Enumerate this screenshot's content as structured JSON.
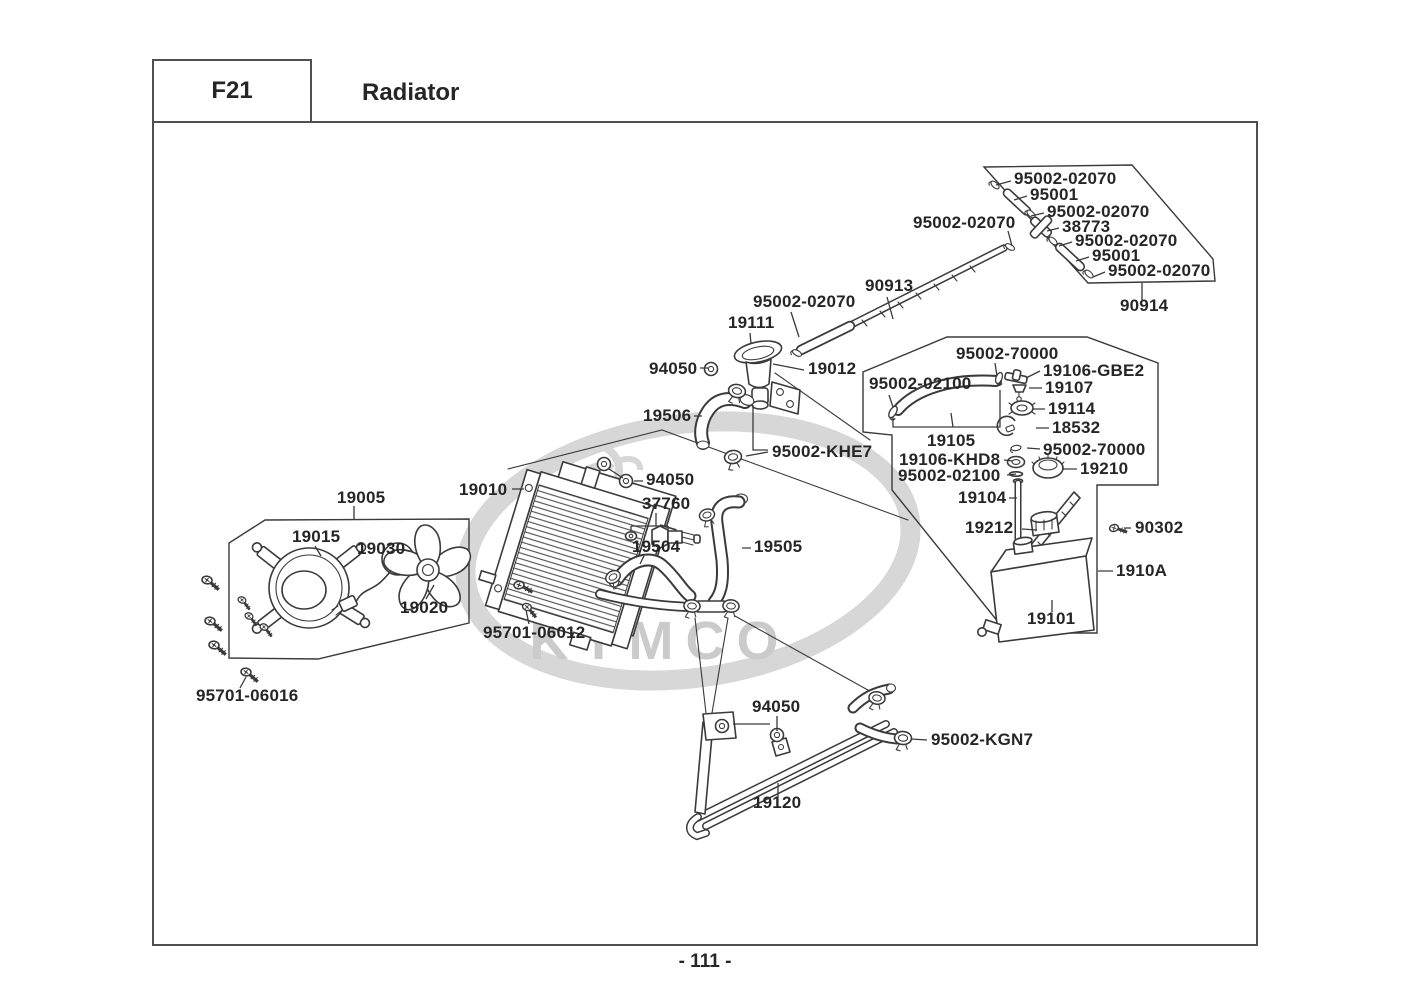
{
  "page": {
    "section_code": "F21",
    "title": "Radiator",
    "page_number": "- 111 -",
    "watermark": "KYMCO"
  },
  "colors": {
    "line": "#3a3a3a",
    "label": "#262626",
    "border": "#4f4f4f",
    "watermark_ring": "#d7d7d7",
    "watermark_text": "#cbcbcb",
    "background": "#ffffff"
  },
  "diagram": {
    "description": "Exploded parts diagram of radiator assembly with part numbers",
    "labels": [
      {
        "text": "95002-02070",
        "x": 1014,
        "y": 179
      },
      {
        "text": "95001",
        "x": 1030,
        "y": 195
      },
      {
        "text": "95002-02070",
        "x": 1047,
        "y": 212
      },
      {
        "text": "38773",
        "x": 1062,
        "y": 227
      },
      {
        "text": "95002-02070",
        "x": 1075,
        "y": 241
      },
      {
        "text": "95001",
        "x": 1092,
        "y": 256
      },
      {
        "text": "95002-02070",
        "x": 1108,
        "y": 271
      },
      {
        "text": "90914",
        "x": 1120,
        "y": 306
      },
      {
        "text": "95002-02070",
        "x": 913,
        "y": 223
      },
      {
        "text": "90913",
        "x": 865,
        "y": 286
      },
      {
        "text": "95002-02070",
        "x": 753,
        "y": 302
      },
      {
        "text": "19111",
        "x": 728,
        "y": 323
      },
      {
        "text": "94050",
        "x": 649,
        "y": 369
      },
      {
        "text": "19012",
        "x": 808,
        "y": 369
      },
      {
        "text": "95002-70000",
        "x": 956,
        "y": 354
      },
      {
        "text": "95002-02100",
        "x": 869,
        "y": 384
      },
      {
        "text": "19106-GBE2",
        "x": 1043,
        "y": 371
      },
      {
        "text": "19107",
        "x": 1045,
        "y": 388
      },
      {
        "text": "19114",
        "x": 1048,
        "y": 409
      },
      {
        "text": "18532",
        "x": 1052,
        "y": 428
      },
      {
        "text": "19105",
        "x": 927,
        "y": 441
      },
      {
        "text": "95002-70000",
        "x": 1043,
        "y": 450
      },
      {
        "text": "19106-KHD8",
        "x": 899,
        "y": 460
      },
      {
        "text": "19210",
        "x": 1080,
        "y": 469
      },
      {
        "text": "95002-02100",
        "x": 898,
        "y": 476
      },
      {
        "text": "19104",
        "x": 958,
        "y": 498
      },
      {
        "text": "19506",
        "x": 643,
        "y": 416
      },
      {
        "text": "95002-KHE7",
        "x": 772,
        "y": 452
      },
      {
        "text": "19005",
        "x": 337,
        "y": 498
      },
      {
        "text": "19010",
        "x": 459,
        "y": 490
      },
      {
        "text": "94050",
        "x": 646,
        "y": 480
      },
      {
        "text": "37760",
        "x": 642,
        "y": 504
      },
      {
        "text": "19015",
        "x": 292,
        "y": 537
      },
      {
        "text": "19030",
        "x": 357,
        "y": 549
      },
      {
        "text": "19504",
        "x": 632,
        "y": 547
      },
      {
        "text": "19505",
        "x": 754,
        "y": 547
      },
      {
        "text": "19212",
        "x": 965,
        "y": 528
      },
      {
        "text": "90302",
        "x": 1135,
        "y": 528
      },
      {
        "text": "1910A",
        "x": 1116,
        "y": 571
      },
      {
        "text": "19020",
        "x": 400,
        "y": 608
      },
      {
        "text": "19101",
        "x": 1027,
        "y": 619
      },
      {
        "text": "95701-06012",
        "x": 483,
        "y": 633
      },
      {
        "text": "95701-06016",
        "x": 196,
        "y": 696
      },
      {
        "text": "94050",
        "x": 752,
        "y": 707
      },
      {
        "text": "95002-KGN7",
        "x": 931,
        "y": 740
      },
      {
        "text": "19120",
        "x": 753,
        "y": 803
      }
    ]
  }
}
